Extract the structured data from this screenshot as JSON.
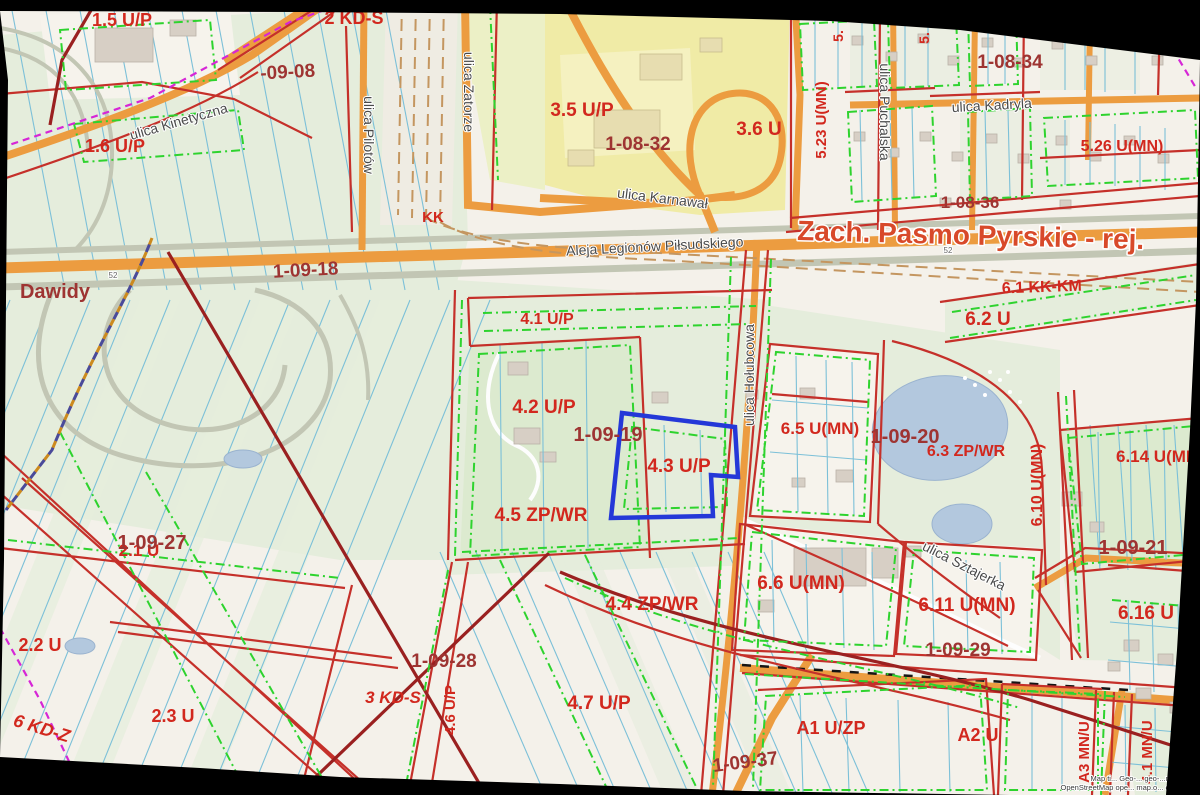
{
  "selected_parcel": {
    "code": "4.3 U/P",
    "area_code": "1-09-19"
  },
  "colors": {
    "zone_label": "#d2281e",
    "area_label": "#9e3432",
    "street_label": "#4a4a4a",
    "district_title": "#d8492a",
    "selected_outline": "#2438d8",
    "water": "#b3c8de",
    "road_orange": "#ec9c40",
    "road_orange_dark": "#cf7f2b",
    "green_dash": "#2ed32e",
    "red_line": "#c5302a",
    "red_dark": "#9a2020",
    "magenta": "#d626d6",
    "railway_tan": "#c49660",
    "field_line_blue": "#7cc0d8",
    "base": "#f4f1ea",
    "green_area": "#e5eddc",
    "yellow_area": "#f0eba6"
  },
  "labels": {
    "district_title": {
      "t": "Zach. Pasmo Pyrskie - rej.",
      "x": 797,
      "y": 240,
      "s": 28,
      "r": 1.5,
      "a": "start"
    },
    "places": [
      {
        "t": "Dawidy",
        "x": 55,
        "y": 298,
        "s": 20
      }
    ],
    "zones": [
      {
        "t": "1.5 U/P",
        "x": 122,
        "y": 26,
        "s": 18
      },
      {
        "t": "2 KD-S",
        "x": 354,
        "y": 24,
        "s": 18
      },
      {
        "t": "1.6 U/P",
        "x": 115,
        "y": 152,
        "s": 18
      },
      {
        "t": "3.5 U/P",
        "x": 582,
        "y": 116,
        "s": 19
      },
      {
        "t": "3.6 U",
        "x": 759,
        "y": 135,
        "s": 19
      },
      {
        "t": "5.",
        "x": 843,
        "y": 36,
        "s": 14,
        "r": -90
      },
      {
        "t": "5.",
        "x": 929,
        "y": 38,
        "s": 14,
        "r": -90
      },
      {
        "t": "5.23 U(MN)",
        "x": 826,
        "y": 120,
        "s": 15,
        "r": -90
      },
      {
        "t": "5.26 U(MN)",
        "x": 1122,
        "y": 151,
        "s": 16
      },
      {
        "t": "KK",
        "x": 433,
        "y": 222,
        "s": 15
      },
      {
        "t": "6.1 KK-KM",
        "x": 1042,
        "y": 292,
        "s": 16,
        "r": -2
      },
      {
        "t": "6.2 U",
        "x": 988,
        "y": 325,
        "s": 19
      },
      {
        "t": "4.1 U/P",
        "x": 547,
        "y": 324,
        "s": 16
      },
      {
        "t": "4.2 U/P",
        "x": 544,
        "y": 413,
        "s": 19
      },
      {
        "t": "4.3 U/P",
        "x": 679,
        "y": 472,
        "s": 19
      },
      {
        "t": "6.5 U(MN)",
        "x": 820,
        "y": 434,
        "s": 17
      },
      {
        "t": "6.3 ZP/WR",
        "x": 966,
        "y": 456,
        "s": 16
      },
      {
        "t": "6.14 U(MN)",
        "x": 1116,
        "y": 462,
        "s": 17,
        "a": "start"
      },
      {
        "t": "6.10 U(MN)",
        "x": 1042,
        "y": 485,
        "s": 16,
        "r": -90
      },
      {
        "t": "4.5 ZP/WR",
        "x": 541,
        "y": 521,
        "s": 19
      },
      {
        "t": "6.6 U(MN)",
        "x": 801,
        "y": 589,
        "s": 19
      },
      {
        "t": "6.11 U(MN)",
        "x": 967,
        "y": 611,
        "s": 19
      },
      {
        "t": "6.16 U",
        "x": 1118,
        "y": 619,
        "s": 19,
        "a": "start"
      },
      {
        "t": "2.1 U",
        "x": 139,
        "y": 556,
        "s": 17
      },
      {
        "t": "2.2 U",
        "x": 40,
        "y": 651,
        "s": 18
      },
      {
        "t": "2.3 U",
        "x": 173,
        "y": 722,
        "s": 18
      },
      {
        "t": "6 KD-Z",
        "x": 40,
        "y": 734,
        "s": 18,
        "r": 17,
        "i": 1
      },
      {
        "t": "3 KD-S",
        "x": 393,
        "y": 703,
        "s": 17,
        "i": 1
      },
      {
        "t": "4.6 U/P",
        "x": 455,
        "y": 710,
        "s": 15,
        "r": -90
      },
      {
        "t": "4.4 ZP/WR",
        "x": 652,
        "y": 610,
        "s": 19
      },
      {
        "t": "4.7 U/P",
        "x": 599,
        "y": 709,
        "s": 19
      },
      {
        "t": "A1 U/ZP",
        "x": 831,
        "y": 734,
        "s": 18
      },
      {
        "t": "A2 U",
        "x": 978,
        "y": 741,
        "s": 18
      },
      {
        "t": "A3 MN/U",
        "x": 1089,
        "y": 752,
        "s": 15,
        "r": -90
      },
      {
        "t": "4.1 MN/U",
        "x": 1152,
        "y": 752,
        "s": 15,
        "r": -90
      }
    ],
    "area_codes": [
      {
        "t": "-09-08",
        "x": 288,
        "y": 78,
        "s": 19,
        "r": -3
      },
      {
        "t": "1-08-32",
        "x": 638,
        "y": 150,
        "s": 19
      },
      {
        "t": "1-08-34",
        "x": 1010,
        "y": 68,
        "s": 19
      },
      {
        "t": "1-08-36",
        "x": 970,
        "y": 208,
        "s": 17
      },
      {
        "t": "1-09-18",
        "x": 306,
        "y": 276,
        "s": 19,
        "r": -3
      },
      {
        "t": "1-09-19",
        "x": 608,
        "y": 441,
        "s": 20
      },
      {
        "t": "1-09-20",
        "x": 905,
        "y": 443,
        "s": 20
      },
      {
        "t": "1-09-21",
        "x": 1133,
        "y": 554,
        "s": 20
      },
      {
        "t": "1-09-27",
        "x": 152,
        "y": 549,
        "s": 20
      },
      {
        "t": "1-09-28",
        "x": 444,
        "y": 667,
        "s": 19
      },
      {
        "t": "1-09-29",
        "x": 958,
        "y": 656,
        "s": 19
      },
      {
        "t": "1-09-37",
        "x": 746,
        "y": 768,
        "s": 19,
        "r": -7
      }
    ],
    "streets": [
      {
        "t": "ulica Kinetyczna",
        "x": 180,
        "y": 126,
        "s": 14,
        "r": -16
      },
      {
        "t": "ulica Pilotów",
        "x": 364,
        "y": 135,
        "s": 14,
        "r": 90
      },
      {
        "t": "ulica Zatorze",
        "x": 464,
        "y": 92,
        "s": 14,
        "r": 90
      },
      {
        "t": "ulica Karnawał",
        "x": 662,
        "y": 203,
        "s": 14,
        "r": 7
      },
      {
        "t": "Aleja Legionów Piłsudskiego",
        "x": 655,
        "y": 251,
        "s": 14,
        "r": -3
      },
      {
        "t": "ulica Kadryla",
        "x": 992,
        "y": 110,
        "s": 14,
        "r": -3
      },
      {
        "t": "ulica Puchalska",
        "x": 880,
        "y": 112,
        "s": 14,
        "r": 90
      },
      {
        "t": "ulica Hołubcowa",
        "x": 754,
        "y": 375,
        "s": 14,
        "r": -90
      },
      {
        "t": "ulica Sztajerka",
        "x": 962,
        "y": 570,
        "s": 14,
        "r": 27
      }
    ],
    "road_numbers": [
      {
        "t": "52",
        "x": 113,
        "y": 278,
        "s": 8
      },
      {
        "t": "52",
        "x": 948,
        "y": 253,
        "s": 8
      }
    ]
  },
  "attribution": {
    "line1": "Map ti... Geo-... geo-...m.com.pl",
    "line2": "OpenStreetMap ope... map.o... copyright"
  }
}
